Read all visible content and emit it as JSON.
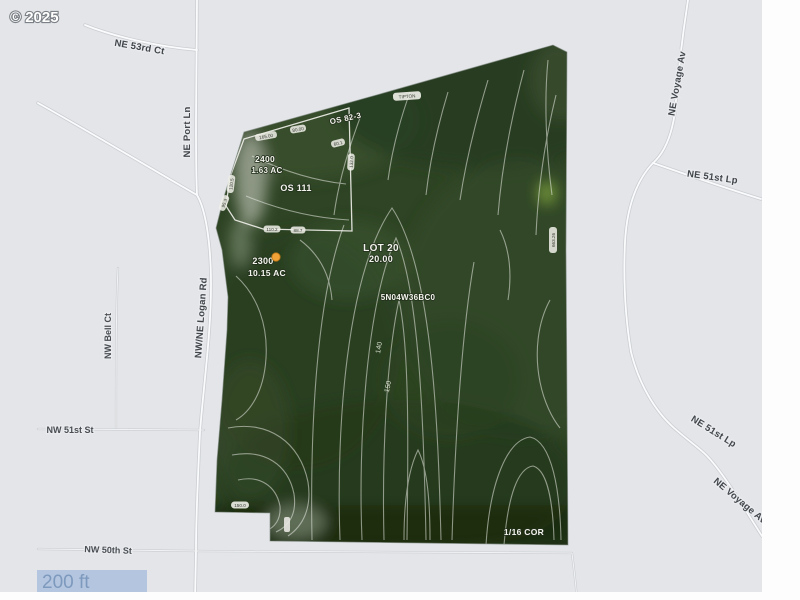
{
  "copyright": "© 2025",
  "scale_bar": {
    "label": "200 ft",
    "bar_color": "#b4c6df",
    "text_color": "#7d99bd"
  },
  "streets": {
    "ne_53rd_ct": "NE 53rd Ct",
    "ne_port_ln": "NE Port Ln",
    "nw_ne_logan_rd": "NW/NE Logan Rd",
    "nw_bell_ct": "NW Bell Ct",
    "nw_51st_st": "NW 51st St",
    "nw_50th_st": "NW 50th St",
    "ne_voyage_av_upper": "NE Voyage Av",
    "ne_51st_lp_upper": "NE 51st Lp",
    "ne_51st_lp_lower": "NE 51st Lp",
    "ne_voyage_av_lower": "NE Voyage Av"
  },
  "parcel": {
    "lot_label": "LOT 20",
    "lot_value": "20.00",
    "taxlot_main": {
      "number": "2300",
      "acreage": "10.15 AC"
    },
    "taxlot_small": {
      "number": "2400",
      "acreage": "1.63 AC"
    },
    "survey_refs": {
      "os_111": "OS 111",
      "os_82_3": "OS 82-3",
      "map_code": "5N04W36BC0",
      "corner": "1/16 COR",
      "name_tag": "TIPTON"
    },
    "contour_labels": {
      "c140": "140",
      "c150": "150"
    },
    "edge_labels": {
      "e1": "165.00",
      "e2": "80.00",
      "e3": "120.5",
      "e4": "95.3",
      "e5": "60.1",
      "e6": "132.0",
      "e7": "110.2",
      "e8": "88.7",
      "e9": "663.26",
      "e10": "150.0"
    },
    "marker_color": "#f2a338"
  },
  "colors": {
    "map_bg": "#e3e5e8",
    "road_fill": "#fafbfc",
    "road_casing": "#cbced2",
    "aerial_base": "#2e4424",
    "contour": "#e9ece4",
    "margin_white": "#fdfdfd"
  }
}
